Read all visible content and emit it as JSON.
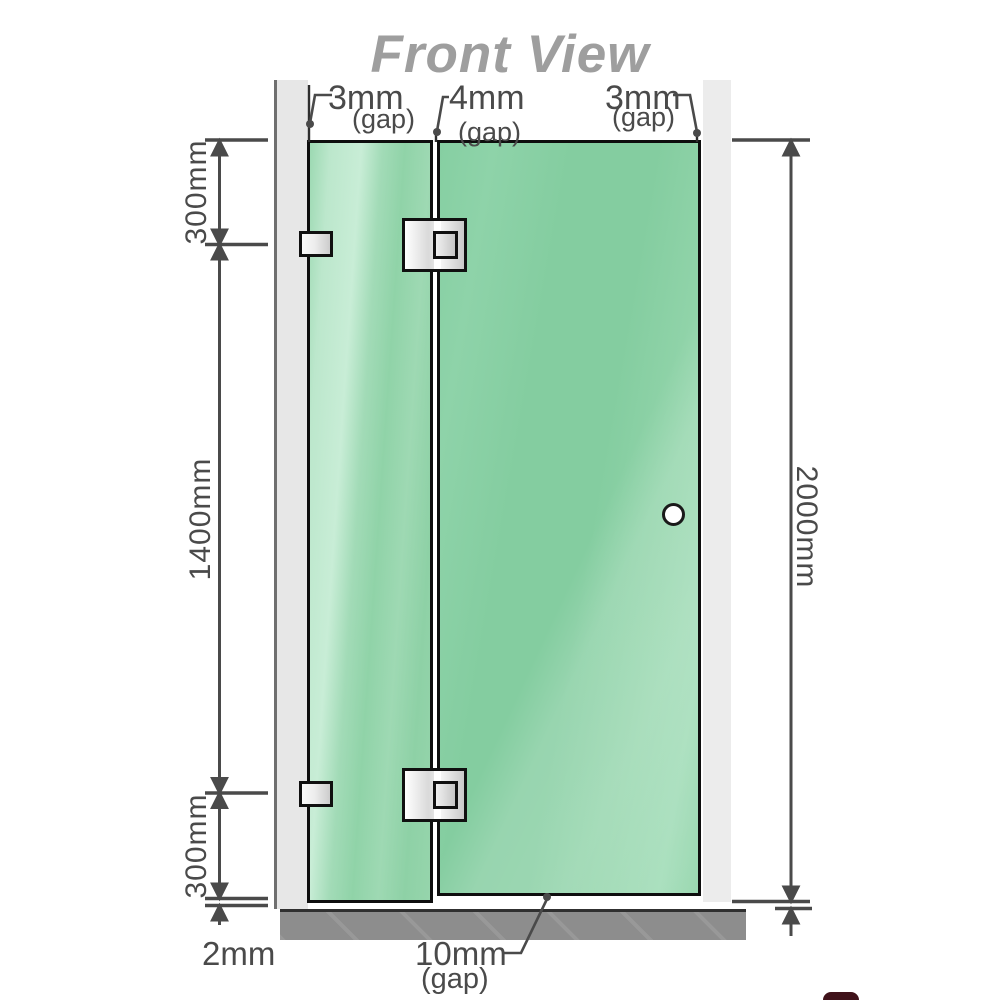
{
  "title": "Front View",
  "dimensions": {
    "top_left_gap": {
      "value": "3mm",
      "qualifier": "(gap)"
    },
    "top_middle_gap": {
      "value": "4mm",
      "qualifier": "(gap)"
    },
    "top_right_gap": {
      "value": "3mm",
      "qualifier": "(gap)"
    },
    "left_top": "300mm",
    "left_middle": "1400mm",
    "left_bottom": "300mm",
    "right_height": "2000mm",
    "bottom_floor_gap": "2mm",
    "bottom_door_gap": {
      "value": "10mm",
      "qualifier": "(gap)"
    }
  },
  "colors": {
    "glass_green": "#8ed2a7",
    "glass_highlight": "#c8edd6",
    "wall_gray": "#e9e9e9",
    "base_gray": "#8d8d8d",
    "outline_black": "#0e0e0e",
    "dimension_gray": "#4a4a4a",
    "title_gray": "#9e9e9e"
  }
}
